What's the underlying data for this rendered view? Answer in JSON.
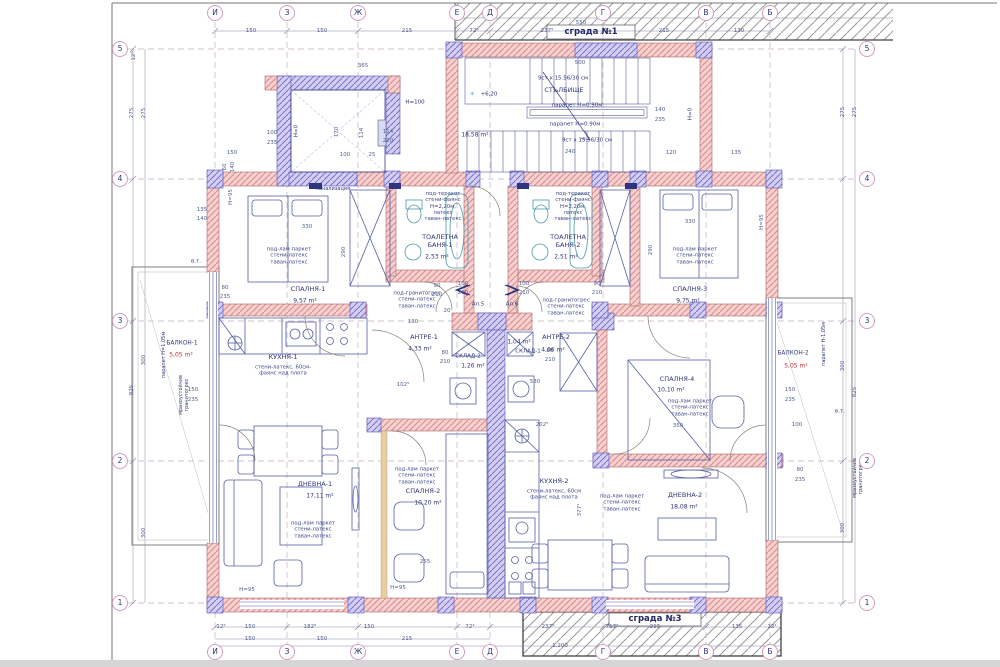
{
  "site": {
    "building_top": "сграда №1",
    "building_bottom": "сграда №3"
  },
  "grid": {
    "letters": [
      {
        "label": "И",
        "x": 215
      },
      {
        "label": "З",
        "x": 287
      },
      {
        "label": "Ж",
        "x": 358
      },
      {
        "label": "Е",
        "x": 457
      },
      {
        "label": "Д",
        "x": 490
      },
      {
        "label": "Г",
        "x": 603
      },
      {
        "label": "В",
        "x": 706
      },
      {
        "label": "Б",
        "x": 770
      }
    ],
    "numbers": [
      {
        "label": "5",
        "y": 49
      },
      {
        "label": "4",
        "y": 179
      },
      {
        "label": "3",
        "y": 321
      },
      {
        "label": "2",
        "y": 461
      },
      {
        "label": "1",
        "y": 603
      }
    ]
  },
  "stairwell": {
    "name": "СТЪЛБИЩЕ",
    "area": "18,58 m²",
    "steps_top": "9ст x 15.56/30 см",
    "steps_bottom": "9ст x 15.56/30 см",
    "parapet_top": "парапет H=0.90м",
    "parapet_bottom": "парапет H=0.90м",
    "elevation": "+6,20",
    "elevation_mark": "✳"
  },
  "notes": {
    "canal": "канализация",
    "vt_left": "в.т.",
    "vt_right": "в.т.",
    "h100": "H=100",
    "h0_lift": "H=0",
    "h0_right": "H=0",
    "ap5": "Ап.5",
    "ap6": "Ап.6"
  },
  "rooms": {
    "bedroom1": {
      "name": "СПАЛНЯ-1",
      "area": "9,57 m²",
      "finish": "под-лам паркет\nстени-латекс\nтаван-латекс"
    },
    "bedroom2": {
      "name": "СПАЛНЯ-2",
      "area": "10,20 m²",
      "finish": "под-лам паркет\nстени-латекс\nтаван-латекс"
    },
    "bedroom3": {
      "name": "СПАЛНЯ-3",
      "area": "9,75 m²",
      "finish": "под-лам паркет\nстени-латекс\nтаван-латекс"
    },
    "bedroom4": {
      "name": "СПАЛНЯ-4",
      "area": "10,10 m²",
      "finish": "под-лам паркет\nстени-латекс\nтаван-латекс"
    },
    "living1": {
      "name": "ДНЕВНА-1",
      "area": "17,11 m²",
      "finish": "под-лам паркет\nстени-латекс\nтаван-латекс"
    },
    "living2": {
      "name": "ДНЕВНА-2",
      "area": "18,08 m²",
      "finish": "под-лам паркет\nстени-латекс\nтаван-латекс"
    },
    "kitchen1": {
      "name": "КУХНЯ-1",
      "finish": "стени-латекс, 60см-\nфаянс над плота"
    },
    "kitchen2": {
      "name": "КУХНЯ-2",
      "finish": "стени-латекс, 60см\nфаянс над плота"
    },
    "bath1": {
      "name": "ТОАЛЕТНА\nБАНЯ-1",
      "area": "2,53 m²",
      "finish": "под-теракот\nстени-фаянс\nH=2,20м,\nлатекс\nтаван-латекс"
    },
    "bath2": {
      "name": "ТОАЛЕТНА\nБАНЯ-2",
      "area": "2,51 m²",
      "finish": "под-теракот\nстени-фаянс\nH=2,20м,\nлатекс\nтаван-латекс"
    },
    "hall1": {
      "name": "АНТРЕ-1",
      "area": "4,33 m²",
      "finish": "под-гранитогрес\nстени-латекс\nтаван-латекс"
    },
    "hall2": {
      "name": "АНТРЕ-2",
      "area": "4,06 m²",
      "finish": "под-гранитогрес\nстени-латекс\nтаван-латекс"
    },
    "storage1": {
      "name": "СКЛАД-1",
      "area": "1,04 m²"
    },
    "storage2": {
      "name": "СКЛАД-2",
      "area": "1,26 m²"
    },
    "balcony1": {
      "name": "БАЛКОН-1",
      "area": "5,05 m²",
      "note1": "парапет H=1,05м",
      "note2": "мразоустойчив\nгранитогрес"
    },
    "balcony2": {
      "name": "БАЛКОН-2",
      "area": "5,05 m²",
      "note1": "парапет H-1,05м",
      "note2": "мразоустойчив\nгранитогрес"
    }
  },
  "dims": [
    {
      "t": "150",
      "x": 251,
      "y": 31
    },
    {
      "t": "150",
      "x": 322,
      "y": 31
    },
    {
      "t": "215",
      "x": 407,
      "y": 31
    },
    {
      "t": "72⁵",
      "x": 474,
      "y": 31
    },
    {
      "t": "237⁵",
      "x": 547,
      "y": 31
    },
    {
      "t": "215",
      "x": 664,
      "y": 31
    },
    {
      "t": "130",
      "x": 739,
      "y": 31
    },
    {
      "t": "550",
      "x": 581,
      "y": 23
    },
    {
      "t": "12⁵",
      "x": 134,
      "y": 56,
      "v": 1
    },
    {
      "t": "365",
      "x": 363,
      "y": 66
    },
    {
      "t": "500",
      "x": 580,
      "y": 63
    },
    {
      "t": "100",
      "x": 272,
      "y": 133
    },
    {
      "t": "235",
      "x": 272,
      "y": 143
    },
    {
      "t": "150",
      "x": 232,
      "y": 153
    },
    {
      "t": "240",
      "x": 570,
      "y": 152
    },
    {
      "t": "120",
      "x": 671,
      "y": 153
    },
    {
      "t": "135",
      "x": 736,
      "y": 153
    },
    {
      "t": "140",
      "x": 660,
      "y": 110
    },
    {
      "t": "235",
      "x": 660,
      "y": 120
    },
    {
      "t": "170",
      "x": 337,
      "y": 132,
      "v": 1
    },
    {
      "t": "114",
      "x": 362,
      "y": 133,
      "v": 1
    },
    {
      "t": "114",
      "x": 388,
      "y": 132
    },
    {
      "t": "220",
      "x": 388,
      "y": 141
    },
    {
      "t": "100",
      "x": 345,
      "y": 155
    },
    {
      "t": "25",
      "x": 372,
      "y": 155
    },
    {
      "t": "60",
      "x": 225,
      "y": 167,
      "v": 1
    },
    {
      "t": "140",
      "x": 233,
      "y": 167,
      "v": 1
    },
    {
      "t": "135",
      "x": 202,
      "y": 210
    },
    {
      "t": "140",
      "x": 202,
      "y": 219
    },
    {
      "t": "330",
      "x": 307,
      "y": 227
    },
    {
      "t": "290",
      "x": 344,
      "y": 252,
      "v": 1
    },
    {
      "t": "330",
      "x": 690,
      "y": 222
    },
    {
      "t": "290",
      "x": 651,
      "y": 250,
      "v": 1
    },
    {
      "t": "80",
      "x": 225,
      "y": 288
    },
    {
      "t": "235",
      "x": 225,
      "y": 297
    },
    {
      "t": "H=95",
      "x": 231,
      "y": 197,
      "v": 1
    },
    {
      "t": "H=95",
      "x": 247,
      "y": 590
    },
    {
      "t": "H=95",
      "x": 398,
      "y": 588
    },
    {
      "t": "H=95",
      "x": 762,
      "y": 222,
      "v": 1
    },
    {
      "t": "90",
      "x": 437,
      "y": 286
    },
    {
      "t": "210",
      "x": 437,
      "y": 295
    },
    {
      "t": "100",
      "x": 463,
      "y": 284
    },
    {
      "t": "210",
      "x": 463,
      "y": 293
    },
    {
      "t": "100",
      "x": 524,
      "y": 284
    },
    {
      "t": "210",
      "x": 524,
      "y": 293
    },
    {
      "t": "90",
      "x": 597,
      "y": 284
    },
    {
      "t": "210",
      "x": 597,
      "y": 293
    },
    {
      "t": "20",
      "x": 447,
      "y": 311
    },
    {
      "t": "130",
      "x": 413,
      "y": 322
    },
    {
      "t": "80",
      "x": 445,
      "y": 353
    },
    {
      "t": "210",
      "x": 445,
      "y": 362
    },
    {
      "t": "80",
      "x": 550,
      "y": 351
    },
    {
      "t": "210",
      "x": 550,
      "y": 360
    },
    {
      "t": "102⁵",
      "x": 403,
      "y": 385
    },
    {
      "t": "202⁵",
      "x": 542,
      "y": 425
    },
    {
      "t": "530",
      "x": 535,
      "y": 382
    },
    {
      "t": "350",
      "x": 678,
      "y": 426
    },
    {
      "t": "255",
      "x": 425,
      "y": 562
    },
    {
      "t": "377¹",
      "x": 580,
      "y": 510,
      "v": 1
    },
    {
      "t": "150",
      "x": 193,
      "y": 390
    },
    {
      "t": "235",
      "x": 193,
      "y": 400
    },
    {
      "t": "150",
      "x": 790,
      "y": 390
    },
    {
      "t": "235",
      "x": 790,
      "y": 400
    },
    {
      "t": "80",
      "x": 800,
      "y": 470
    },
    {
      "t": "235",
      "x": 800,
      "y": 480
    },
    {
      "t": "100",
      "x": 797,
      "y": 425
    },
    {
      "t": "12⁵",
      "x": 221,
      "y": 627
    },
    {
      "t": "150",
      "x": 250,
      "y": 627
    },
    {
      "t": "182⁵",
      "x": 310,
      "y": 627
    },
    {
      "t": "150",
      "x": 369,
      "y": 627
    },
    {
      "t": "72⁴",
      "x": 470,
      "y": 627
    },
    {
      "t": "237⁵",
      "x": 548,
      "y": 627
    },
    {
      "t": "717⁵",
      "x": 612,
      "y": 627
    },
    {
      "t": "215",
      "x": 655,
      "y": 627
    },
    {
      "t": "135",
      "x": 737,
      "y": 627
    },
    {
      "t": "12⁴",
      "x": 772,
      "y": 627
    },
    {
      "t": "150",
      "x": 250,
      "y": 639
    },
    {
      "t": "150",
      "x": 322,
      "y": 639
    },
    {
      "t": "215",
      "x": 407,
      "y": 639
    },
    {
      "t": "1.200",
      "x": 560,
      "y": 646
    },
    {
      "t": "275",
      "x": 132,
      "y": 113,
      "v": 1
    },
    {
      "t": "275",
      "x": 144,
      "y": 113,
      "v": 1
    },
    {
      "t": "825",
      "x": 132,
      "y": 390,
      "v": 1
    },
    {
      "t": "300",
      "x": 144,
      "y": 360,
      "v": 1
    },
    {
      "t": "300",
      "x": 144,
      "y": 533,
      "v": 1
    },
    {
      "t": "275",
      "x": 843,
      "y": 112,
      "v": 1
    },
    {
      "t": "275",
      "x": 855,
      "y": 112,
      "v": 1
    },
    {
      "t": "300",
      "x": 843,
      "y": 366,
      "v": 1
    },
    {
      "t": "825",
      "x": 855,
      "y": 392,
      "v": 1
    },
    {
      "t": "300",
      "x": 843,
      "y": 528,
      "v": 1
    }
  ],
  "colors": {
    "wall_pink": "#f6cfcf",
    "wall_stroke": "#a96a6a",
    "column_purple": "#cfcaf0",
    "column_stroke": "#5a54b8",
    "furniture_blue": "#5560a8",
    "fixture_teal": "#4a9aa8",
    "dim_text": "#51608f",
    "label_navy": "#2f3577",
    "area_red": "#c03030",
    "hatch_gray": "#979797"
  }
}
